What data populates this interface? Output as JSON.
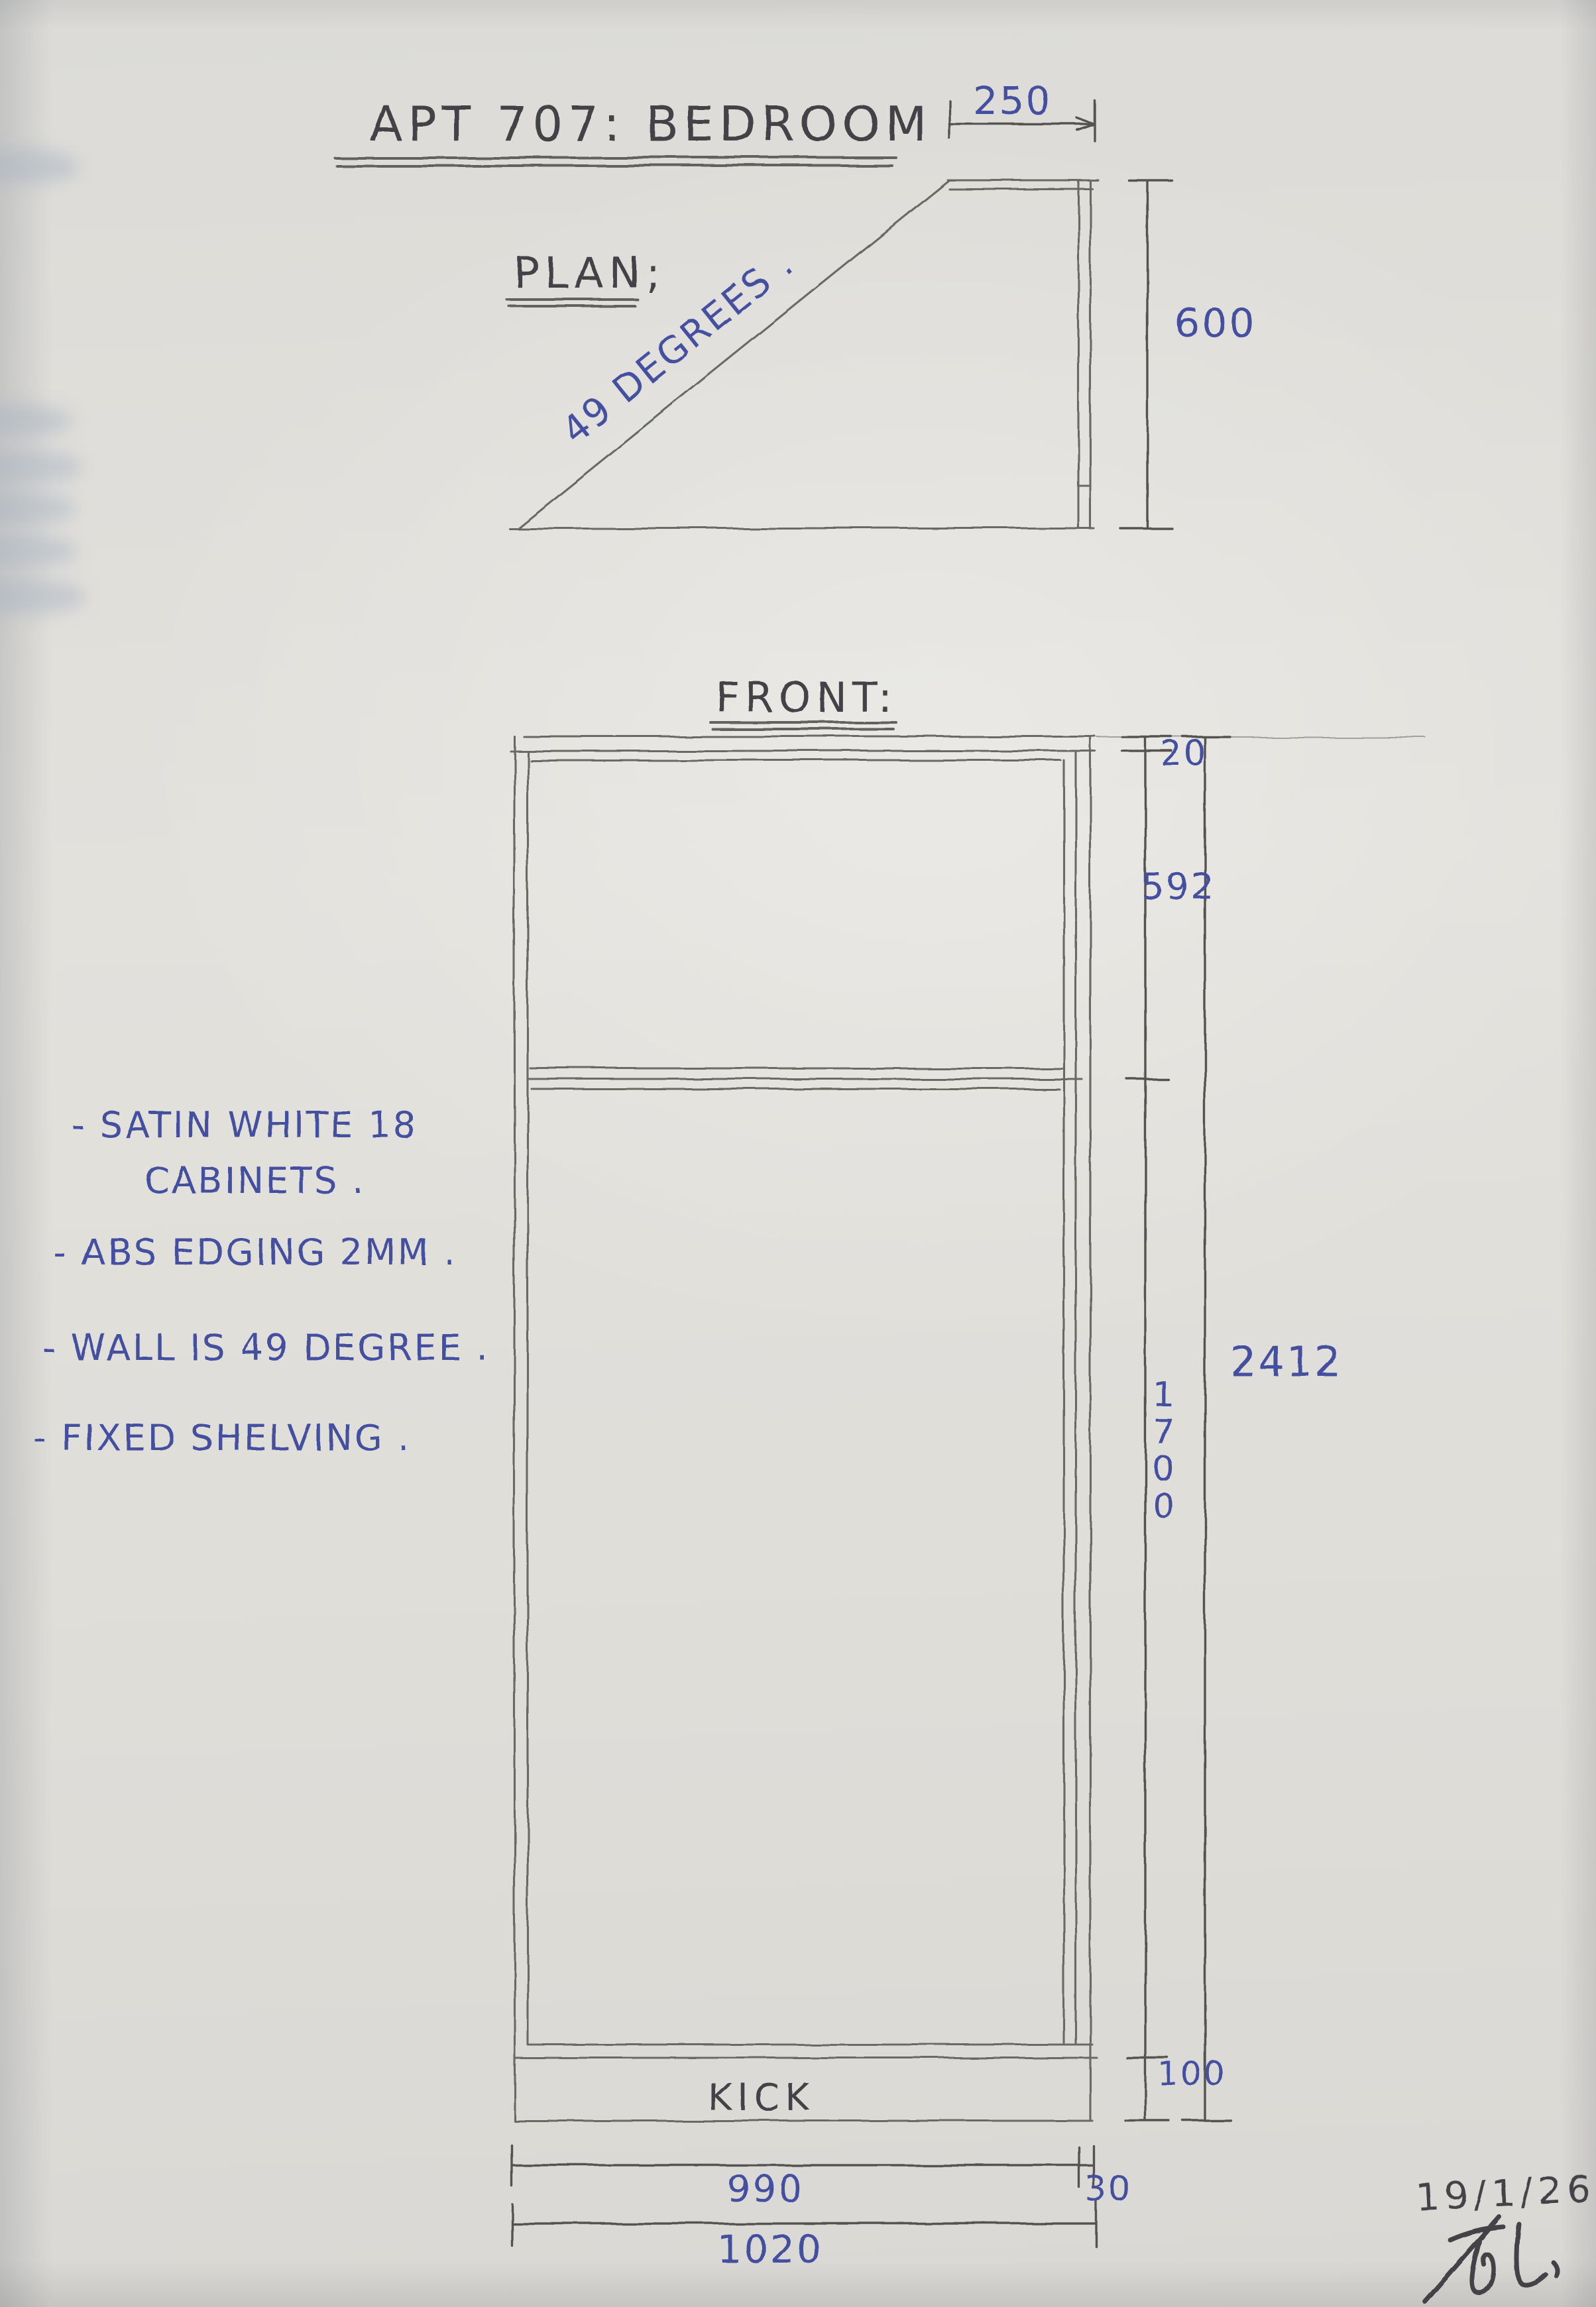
{
  "colors": {
    "paper": "#e1dfda",
    "pencil": "#6a6964",
    "pencil-dark": "#54534f",
    "ink": "#434347",
    "blue": "#4450a0",
    "shadow": "#a9b4c2"
  },
  "header": {
    "title": "APT 707:  BEDROOM"
  },
  "plan": {
    "label": "PLAN;",
    "angle_note": "49 DEGREES .",
    "dims": {
      "top_width": "250",
      "depth": "600"
    }
  },
  "front": {
    "label": "FRONT:",
    "kick_label": "KICK",
    "dims": {
      "top_panel": "20",
      "upper_height": "592",
      "lower_height": "1700",
      "kick_height": "100",
      "overall_height": "2412",
      "cabinet_width": "990",
      "filler_width": "30",
      "overall_width": "1020"
    }
  },
  "notes": {
    "line1": "- SATIN WHITE 18",
    "line2": "CABINETS .",
    "line3": "- ABS EDGING 2MM .",
    "line4": "- WALL IS 49 DEGREE .",
    "line5": "- FIXED SHELVING ."
  },
  "footer": {
    "date": "19/1/26",
    "signature": "Toli"
  }
}
